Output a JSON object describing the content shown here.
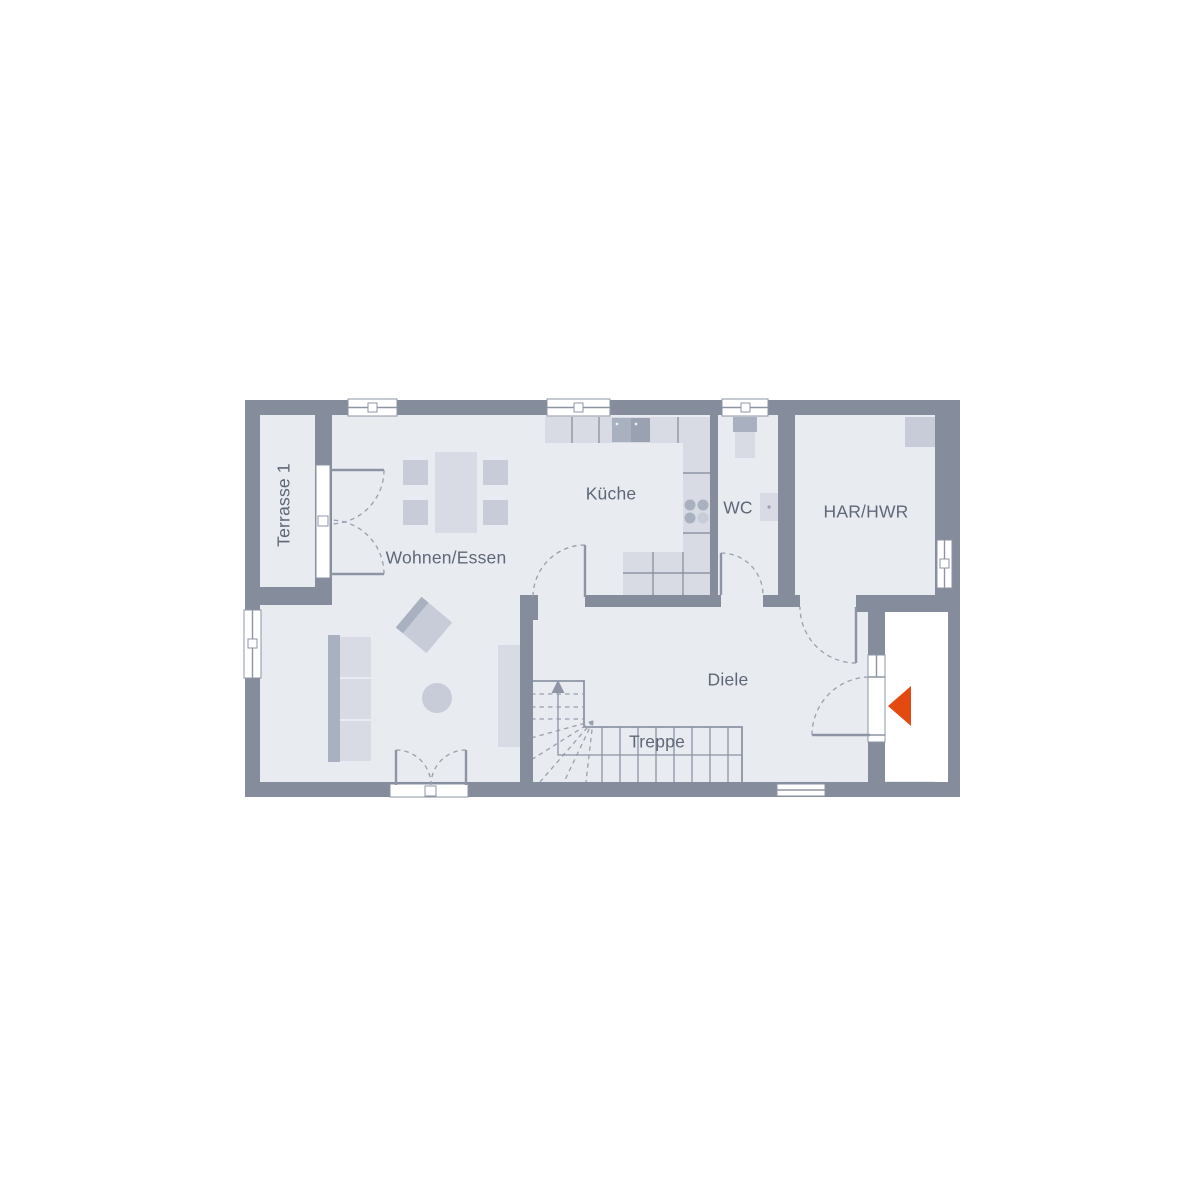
{
  "title": "Grundriss Erdgeschoss",
  "rooms": [
    {
      "id": "terrasse",
      "label": "Terrasse 1"
    },
    {
      "id": "wohnen_essen",
      "label": "Wohnen/Essen"
    },
    {
      "id": "kueche",
      "label": "Küche"
    },
    {
      "id": "wc",
      "label": "WC"
    },
    {
      "id": "har_hwr",
      "label": "HAR/HWR"
    },
    {
      "id": "diele",
      "label": "Diele"
    },
    {
      "id": "treppe",
      "label": "Treppe"
    }
  ],
  "icons": {
    "entrance_arrow": "triangle-pointing-left"
  },
  "colors": {
    "background": "#ffffff",
    "wall": "#858d9c",
    "floor": "#e8ebf0",
    "porch": "#ffffff",
    "window_fill": "#ffffff",
    "line": "#8d95a4",
    "dash": "#99a0ae",
    "text": "#5f6876",
    "furniture_light": "#d8dbe3",
    "furniture_medium": "#c8ccd8",
    "furniture_dark": "#a9b0bf",
    "appliance": "#9aa2b2",
    "accent": "#e24a10"
  }
}
